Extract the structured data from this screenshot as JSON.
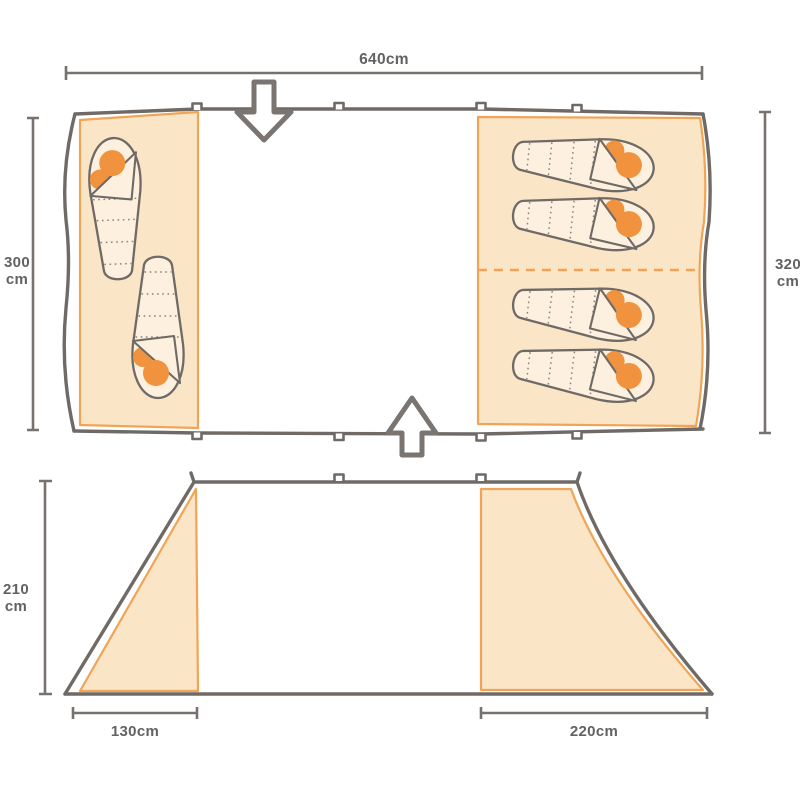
{
  "page": {
    "type": "tent dimensions diagram",
    "views": [
      "top-view floor plan",
      "side profile"
    ]
  },
  "floor_plan": {
    "total_width_label": "640cm",
    "left_bedroom": {
      "depth_value": "300",
      "depth_unit": "cm",
      "sleeping_bag_count": 2
    },
    "right_bedroom": {
      "depth_value": "320",
      "depth_unit": "cm",
      "sleeping_bag_count": 4,
      "divider_style": "dashed"
    },
    "entrance_icons": [
      "arrow-down-icon",
      "arrow-up-icon"
    ]
  },
  "side_view": {
    "height_value": "210",
    "height_unit": "cm",
    "left_porch_width_label": "130cm",
    "right_bedroom_width_label": "220cm"
  },
  "colors": {
    "room_fill": "#FAE5C7",
    "sleeping_bag_fill": "#FDF0DE",
    "orange_accent_line": "#F0A455",
    "person_orange": "#F0923E",
    "wall_gray": "#6F6A66",
    "dimension_gray": "#77726E",
    "label_text_gray": "#626262",
    "background": "#FFFFFF"
  }
}
